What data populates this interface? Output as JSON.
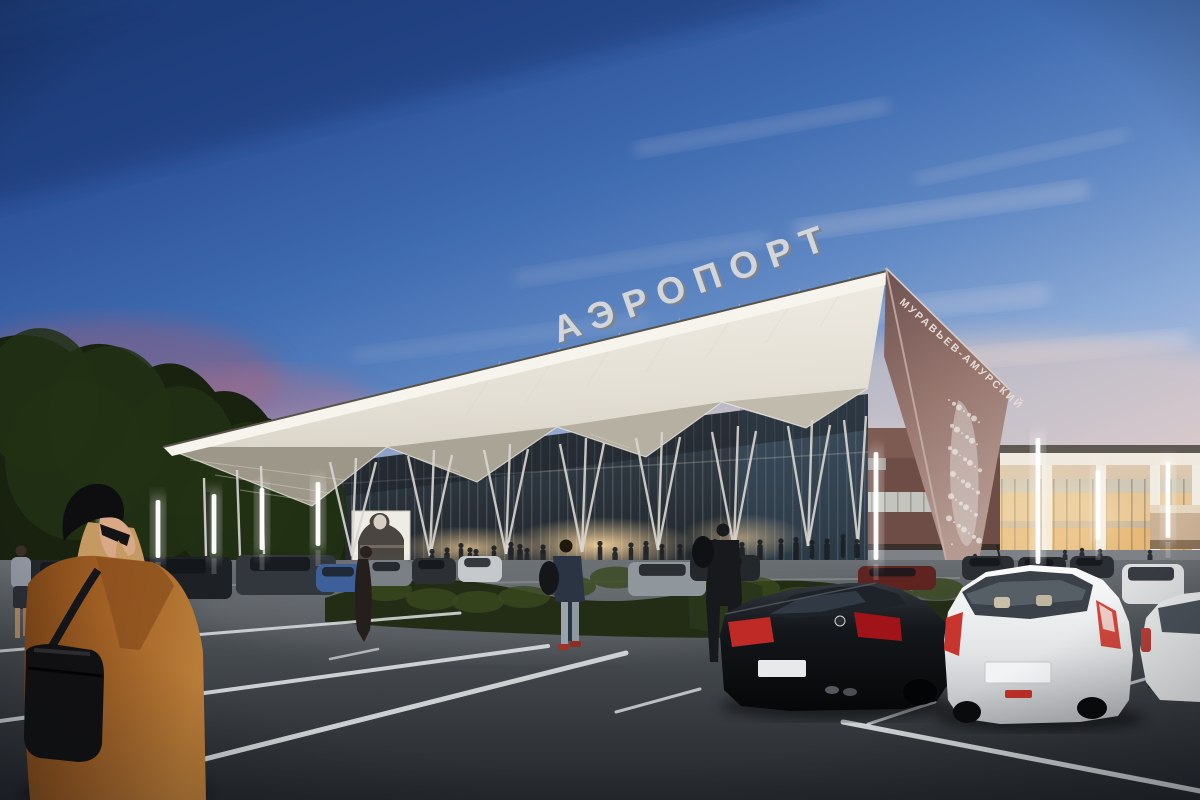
{
  "scene": {
    "kind": "architectural rendering photo, airport terminal at dusk",
    "signs": {
      "roof": "АЭРОПОРТ",
      "fin": "МУРАВЬЕВ-АМУРСКИЙ"
    },
    "palette": {
      "sky_top": "#1c3c7a",
      "sky_mid": "#4f7ab8",
      "sky_pink": "#e9ccc4",
      "canopy_white": "#f2efe8",
      "canopy_shade": "#a8a296",
      "fin_dark": "#6e5150",
      "fin_light": "#b59a92",
      "glass_dark": "#2c343c",
      "window_glow": "#e8c793",
      "building_beige": "#d4c0a6",
      "tree_dark": "#18220f",
      "asphalt_dark": "#24282c",
      "asphalt_light": "#6a6f74",
      "line_white": "#dde0e2",
      "coat_camel": "#a05f24",
      "taillight_red": "#c02a26"
    }
  }
}
